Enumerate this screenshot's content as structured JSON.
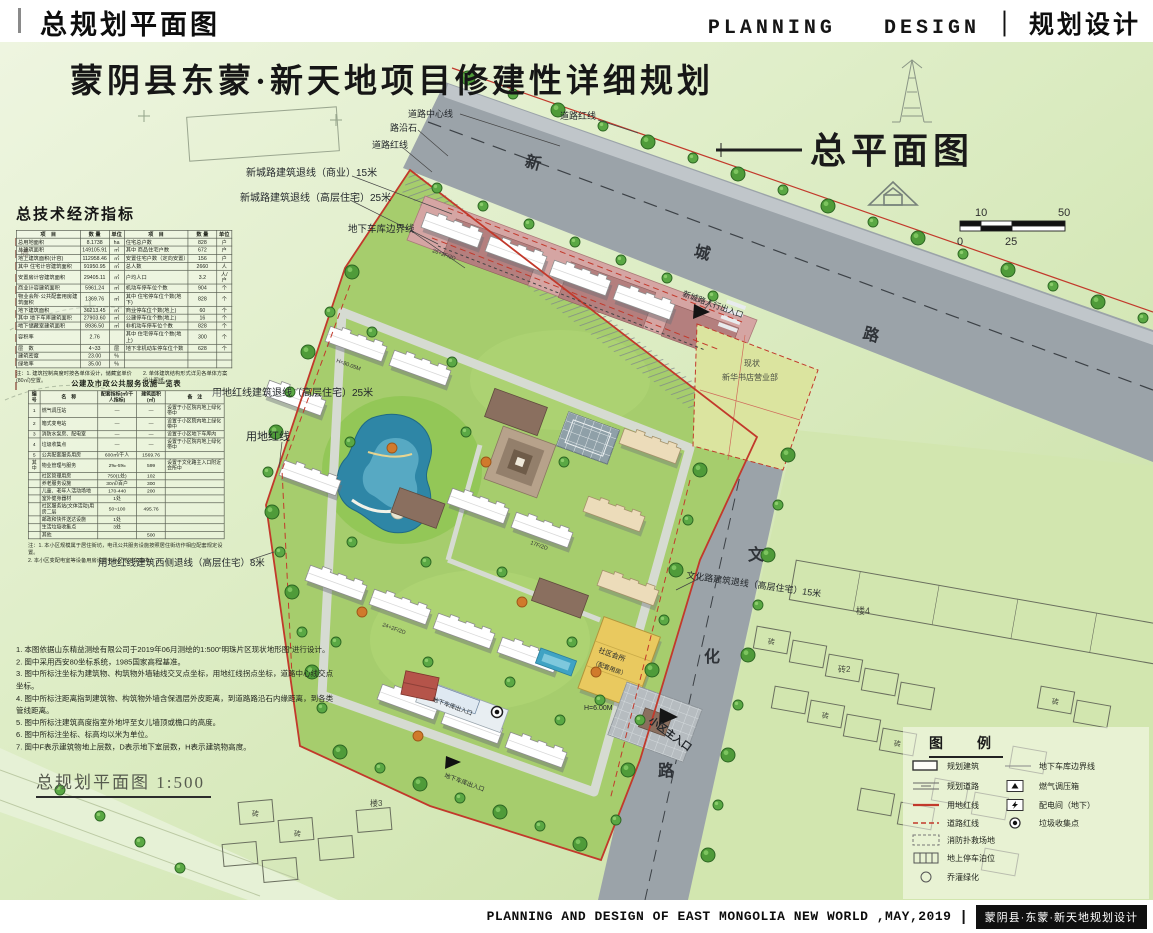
{
  "colors": {
    "board_green": "#dcecc4",
    "road_gray": "#9ba3a9",
    "site_green": "#a6cd6d",
    "red_line": "#c2392b",
    "lake_blue": "#2e86a6",
    "accent_pink": "#d5a5a3",
    "clubhouse_yellow": "#e9c95f"
  },
  "header": {
    "left_title": "总规划平面图",
    "right_en": "PLANNING   DESIGN",
    "divider": "｜",
    "right_cn": "规划设计"
  },
  "board": {
    "main_title": "蒙阴县东蒙·新天地项目修建性详细规划",
    "plan_title": "总平面图",
    "caption": "总规划平面图 1:500"
  },
  "scale_bar": {
    "top_left": "10",
    "top_right": "50",
    "bottom_left": "0",
    "bottom_mid": "25"
  },
  "indicators": {
    "title": "总技术经济指标",
    "headers": [
      "项　目",
      "数 量",
      "单位",
      "项　目",
      "数 量",
      "单位"
    ],
    "rows": [
      [
        "总用地面积",
        "8.1738",
        "ha",
        "住宅总户数",
        "828",
        "户"
      ],
      [
        "总建筑面积",
        "149105.91",
        "㎡",
        "其中 商品住宅户数",
        "672",
        "户"
      ],
      [
        "地上建筑面积(计容)",
        "112958.46",
        "㎡",
        "安置住宅户数（定向安置）",
        "156",
        "户"
      ],
      [
        "其中 住宅计容建筑面积",
        "91950.95",
        "㎡",
        "总人数",
        "2660",
        "人"
      ],
      [
        "安置房计容建筑面积",
        "29405.11",
        "㎡",
        "户均人口",
        "3.2",
        "人/户"
      ],
      [
        "商业计容建筑面积",
        "5961.24",
        "㎡",
        "机动车停车位个数",
        "904",
        "个"
      ],
      [
        "物业会所·公共配套用房建筑面积",
        "1369.76",
        "㎡",
        "其中 住宅停车位个数(地下)",
        "828",
        "个"
      ],
      [
        "地下建筑面积",
        "36213.45",
        "㎡",
        "商业停车位个数(地上)",
        "60",
        "个"
      ],
      [
        "其中 地下车库建筑面积",
        "27903.60",
        "㎡",
        "公建停车位个数(地上)",
        "16",
        "个"
      ],
      [
        "地下储藏室建筑面积",
        "8936.50",
        "㎡",
        "非机动车停车位个数",
        "828",
        "个"
      ],
      [
        "容积率",
        "2.76",
        "",
        "其中 住宅停车位个数(地上)",
        "300",
        "个"
      ],
      [
        "层　数",
        "4~33",
        "层",
        "地下非机动车停车位个数",
        "628",
        "个"
      ],
      [
        "建筑密度",
        "23.00",
        "%",
        "",
        "",
        ""
      ],
      [
        "绿地率",
        "35.00",
        "%",
        "",
        "",
        ""
      ]
    ],
    "note_left": "注：1. 建筑控制高度时按各单体设计，储藏室单价(80㎡)空置。",
    "note_right": "2. 单体建筑结构形式详见各单体方案设计图纸。"
  },
  "facilities": {
    "title": "公建及市政公共服务设施一览表",
    "headers": [
      "编号",
      "名　称",
      "配套指标(㎡/千人指标)",
      "建筑面积(㎡)",
      "备　注"
    ],
    "rows": [
      [
        "1",
        "燃气调压站",
        "—",
        "—",
        "设置于小区院内地上绿化带中"
      ],
      [
        "2",
        "箱式变电站",
        "—",
        "—",
        "设置于小区院内地上绿化带中"
      ],
      [
        "3",
        "消防水泵房、配电室",
        "—",
        "—",
        "设置于小区地下车库内"
      ],
      [
        "4",
        "垃圾收集点",
        "—",
        "—",
        "设置于小区院内地上绿化带中"
      ],
      [
        "5",
        "公共配套服务用房",
        "600㎡/千人",
        "1569.76",
        ""
      ],
      [
        "其中",
        "物业管理与服务",
        "2‰-5‰",
        "599",
        "设置于文化路主入口附近会所中"
      ],
      [
        "",
        "社区管理用房",
        "750(1处)",
        "102",
        ""
      ],
      [
        "",
        "养老服务设施",
        "30㎡/百户",
        "300",
        ""
      ],
      [
        "",
        "儿童、老年人活动场地",
        "170-440",
        "200",
        ""
      ],
      [
        "",
        "室外健身器材",
        "1处",
        "",
        ""
      ],
      [
        "",
        "社区服务站(文体活动)用房二层",
        "50~100",
        "495.76",
        ""
      ],
      [
        "",
        "邮政和快件送达设施",
        "1处",
        "",
        ""
      ],
      [
        "",
        "生活垃圾收集点",
        "3处",
        "",
        ""
      ],
      [
        "",
        "其他",
        "",
        "500",
        ""
      ]
    ],
    "note_1": "注：1. 本小区规模属于居住街坊，电讯公共服务设施按照居住街坊作相应配套规定设置。",
    "note_2": "2. 本小区变配电室等设备用房设置于小区地下车库内。"
  },
  "notes": {
    "items": [
      "1. 本图依据山东精益测绘有限公司于2019年06月测绘的1:500“明珠片区现状地形图”进行设计。",
      "2. 图中采用西安80坐标系统，1985国家高程基准。",
      "3. 图中所标注坐标为建筑物、构筑物外墙轴线交叉点坐标，用地红线拐点坐标，道路中心线交点坐标。",
      "4. 图中所标注距离指到建筑物、构筑物外墙含保温层外皮距离，到道路路沿石内缘距离，到各类管线距离。",
      "5. 图中所标注建筑高度指室外地坪至女儿墙顶或檐口的高度。",
      "6. 图中所标注坐标、标高均以米为单位。",
      "7. 图中F表示建筑物地上层数，D表示地下室层数，H表示建筑物高度。"
    ]
  },
  "legend": {
    "title": "图　例",
    "items_left": [
      {
        "label": "规划建筑"
      },
      {
        "label": "规划道路"
      },
      {
        "label": "用地红线"
      },
      {
        "label": "道路红线"
      },
      {
        "label": "消防扑救场地"
      },
      {
        "label": "地上停车泊位"
      },
      {
        "label": "乔灌绿化"
      }
    ],
    "items_right": [
      {
        "label": "地下车库边界线"
      },
      {
        "label": "燃气调压箱"
      },
      {
        "label": "配电间（地下）"
      },
      {
        "label": "垃圾收集点"
      }
    ]
  },
  "map_labels": {
    "road_center_line": "道路中心线",
    "road_red_line_a": "道路红线",
    "curb": "路沿石",
    "road_red_line_b": "道路红线",
    "setback_commercial": "新城路建筑退线（商业）15米",
    "setback_highrise": "新城路建筑退线（高层住宅）25米",
    "garage_boundary": "地下车库边界线",
    "xincheng_1": "新",
    "xincheng_2": "城",
    "xincheng_3": "路",
    "ped_entrance": "新城路人行出入口",
    "existing_line1": "现状",
    "existing_line2": "新华书店营业部",
    "redline_setback_25": "用地红线建筑退线（高层住宅）25米",
    "site_redline": "用地红线",
    "west_setback": "用地红线建筑西侧退线（高层住宅）8米",
    "wenhua_setback": "文化路建筑退线（高层住宅）15米",
    "wenhua_1": "文",
    "wenhua_2": "化",
    "wenhua_3": "路",
    "main_entrance": "小区主入口",
    "clubhouse_line1": "社区会所",
    "clubhouse_line2": "（配套用房）",
    "clubhouse_height": "H=6.00M",
    "garage_entrance": "地下车库出入口",
    "wall": "墙",
    "bldg_lou4": "楼4",
    "bldg_zhuan2": "砖2",
    "bldg_zhuan": "砖",
    "bldg_lou3": "楼3",
    "anno_a": "26+2F/2D",
    "anno_b": "H=80.05M",
    "anno_c": "24+2F/2D",
    "anno_d": "17F/2D"
  },
  "footer": {
    "en_text": "PLANNING AND DESIGN OF EAST MONGOLIA NEW WORLD ,MAY,2019",
    "divider": "|",
    "badge": "蒙阴县·东蒙·新天地规划设计"
  }
}
